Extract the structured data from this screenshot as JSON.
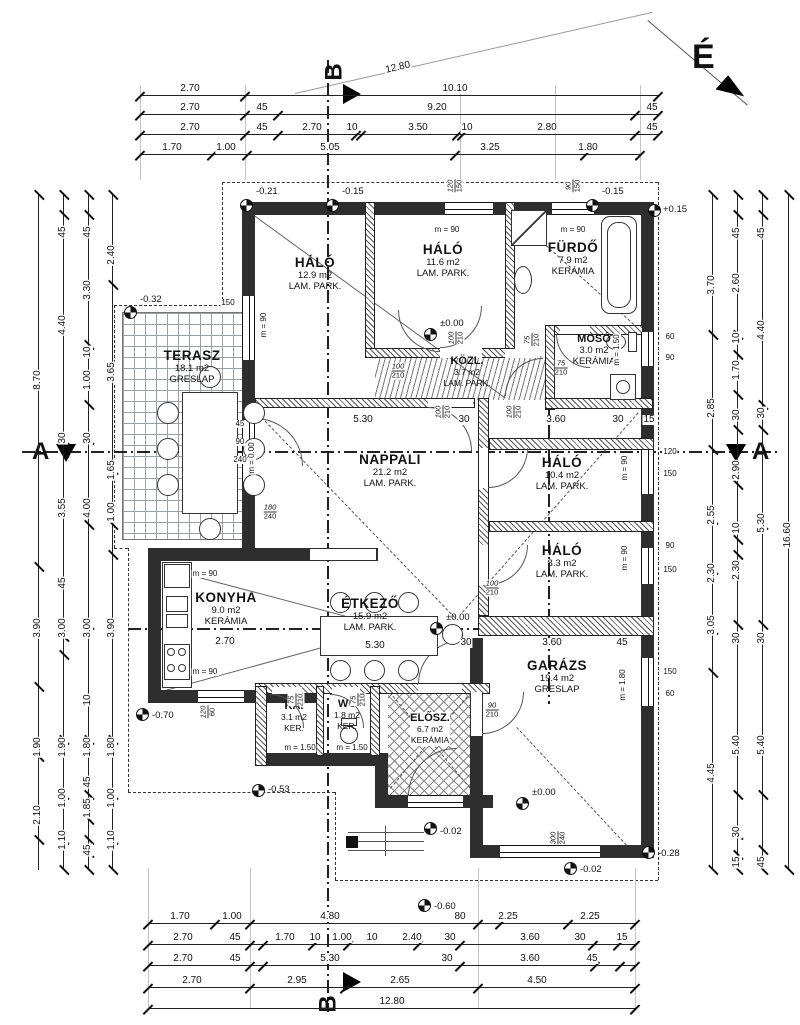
{
  "north": {
    "label": "É"
  },
  "sections": {
    "a": "A",
    "b": "B"
  },
  "rooms": [
    {
      "name": "TERASZ",
      "area": "18.1 m2",
      "floor": "GRESLAP"
    },
    {
      "name": "HÁLÓ",
      "area": "12.9 m2",
      "floor": "LAM. PARK."
    },
    {
      "name": "HÁLÓ",
      "area": "11.6 m2",
      "floor": "LAM. PARK."
    },
    {
      "name": "FÜRDŐ",
      "area": "7.9 m2",
      "floor": "KERÁMIA"
    },
    {
      "name": "MOSÓ",
      "area": "3.0 m2",
      "floor": "KERÁMIA"
    },
    {
      "name": "KÖZL.",
      "area": "3.7 m2",
      "floor": "LAM. PARK."
    },
    {
      "name": "NAPPALI",
      "area": "21.2 m2",
      "floor": "LAM. PARK."
    },
    {
      "name": "HÁLÓ",
      "area": "10.4 m2",
      "floor": "LAM. PARK."
    },
    {
      "name": "HÁLÓ",
      "area": "8.3 m2",
      "floor": "LAM. PARK."
    },
    {
      "name": "KONYHA",
      "area": "9.0 m2",
      "floor": "KERÁMIA"
    },
    {
      "name": "ÉTKEZŐ",
      "area": "15.9 m2",
      "floor": "LAM. PARK."
    },
    {
      "name": "KA.",
      "area": "3.1 m2",
      "floor": "KER."
    },
    {
      "name": "WC",
      "area": "1.8 m2",
      "floor": "KER."
    },
    {
      "name": "ELŐSZ.",
      "area": "6.7 m2",
      "floor": "KERÁMIA"
    },
    {
      "name": "GARÁZS",
      "area": "19.4 m2",
      "floor": "GRESLAP"
    }
  ],
  "levels": [
    "-0.21",
    "-0.15",
    "-0.15",
    "+0.15",
    "-0.32",
    "±0.00",
    "±0.00",
    "±0.00",
    "-0.70",
    "-0.53",
    "-0.02",
    "-0.02",
    "-0.28",
    "-0.60"
  ],
  "dims": {
    "top": {
      "r1": [
        "12.80"
      ],
      "r2": [
        "2.70",
        "10.10"
      ],
      "r3": [
        "2.70",
        "45",
        "9.20",
        "45"
      ],
      "r4": [
        "2.70",
        "45",
        "2.70",
        "10",
        "3.50",
        "10",
        "2.80",
        "45"
      ],
      "r5": [
        "1.70",
        "1.00",
        "5.05",
        "3.25",
        "1.80"
      ]
    },
    "bottom": {
      "r1": [
        "1.70",
        "1.00",
        "4.80",
        "80",
        "2.25",
        "2.25"
      ],
      "r2": [
        "2.70",
        "45",
        "1.70",
        "10",
        "1.00",
        "10",
        "2.40",
        "30",
        "3.60",
        "30",
        "15"
      ],
      "r3": [
        "2.70",
        "45",
        "5.30",
        "30",
        "3.60",
        "45"
      ],
      "r4": [
        "2.70",
        "2.95",
        "2.65",
        "4.50"
      ],
      "r5": [
        "12.80"
      ]
    },
    "left": {
      "c1": [
        "8.70",
        "3.90",
        "1.90",
        "2.10"
      ],
      "c2": [
        "45",
        "4.40",
        "30",
        "3.55",
        "45",
        "3.00",
        "1.90",
        "1.00",
        "1.10"
      ],
      "c3": [
        "45",
        "3.30",
        "10",
        "1.00",
        "30",
        "4.00",
        "3.00",
        "10",
        "1.80",
        "45",
        "1.85",
        "45"
      ],
      "c4": [
        "2.40",
        "3.65",
        "1.65",
        "1.00",
        "3.90",
        "1.80",
        "1.00",
        "1.10"
      ]
    },
    "right": {
      "c1": [
        "3.70",
        "2.85",
        "2.55",
        "2.30",
        "3.05",
        "4.45"
      ],
      "c2": [
        "45",
        "2.60",
        "10",
        "1.70",
        "30",
        "2.90",
        "10",
        "2.30",
        "30",
        "5.40",
        "30",
        "15"
      ],
      "c3": [
        "45",
        "4.40",
        "30",
        "5.30",
        "30",
        "5.40",
        "45"
      ],
      "c4": [
        "16.60"
      ]
    },
    "inner": [
      "5.30",
      "30",
      "3.60",
      "30",
      "15",
      "2.70",
      "5.30",
      "30",
      "3.60",
      "45"
    ]
  },
  "sills": [
    "m = 90",
    "m = 90",
    "m = 90",
    "m = 90",
    "m = 90",
    "m = 90",
    "m = 90",
    "m = 1.50",
    "m = 1.50",
    "m = 1.50",
    "m = 1.80",
    "m = 0.00"
  ],
  "pairs": [
    [
      "100",
      "210"
    ],
    [
      "100",
      "210"
    ],
    [
      "75",
      "210"
    ],
    [
      "75",
      "210"
    ],
    [
      "100",
      "210"
    ],
    [
      "100",
      "210"
    ],
    [
      "100",
      "210"
    ],
    [
      "75",
      "210"
    ],
    [
      "75",
      "210"
    ],
    [
      "90",
      "210"
    ],
    [
      "120",
      "150"
    ],
    [
      "90",
      "150"
    ],
    [
      "180",
      "240"
    ],
    [
      "120",
      "60"
    ],
    [
      "300",
      "240"
    ]
  ],
  "side": [
    "60",
    "90",
    "120",
    "150",
    "90",
    "150",
    "150",
    "60",
    "150",
    "45",
    "90",
    "240"
  ]
}
